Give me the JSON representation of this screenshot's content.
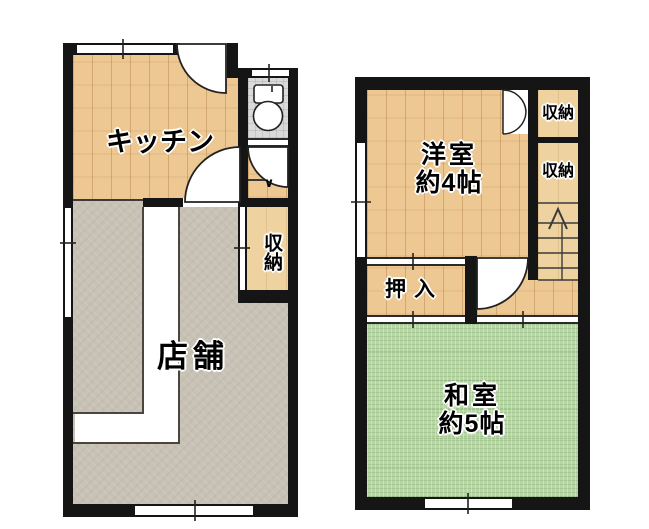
{
  "title": "two-floor apartment floor plan",
  "colors": {
    "wall": "#151515",
    "wood_floor": "#eec893",
    "closet_floor": "#eed3a0",
    "tatami": "#b6d7a5",
    "shop_floor": "#c8c2b6",
    "tile_floor": "#dadada"
  },
  "first_floor": {
    "kitchen_label": "キッチン",
    "storage_label": "収納",
    "shop_label": "店舗",
    "entry_mark": "∨"
  },
  "second_floor": {
    "western_room_label": "洋室",
    "western_room_size": "約4帖",
    "closet_top_label": "収納",
    "closet_mid_label": "収納",
    "oshiire_label": "押入",
    "japanese_room_label": "和室",
    "japanese_room_size": "約5帖"
  }
}
